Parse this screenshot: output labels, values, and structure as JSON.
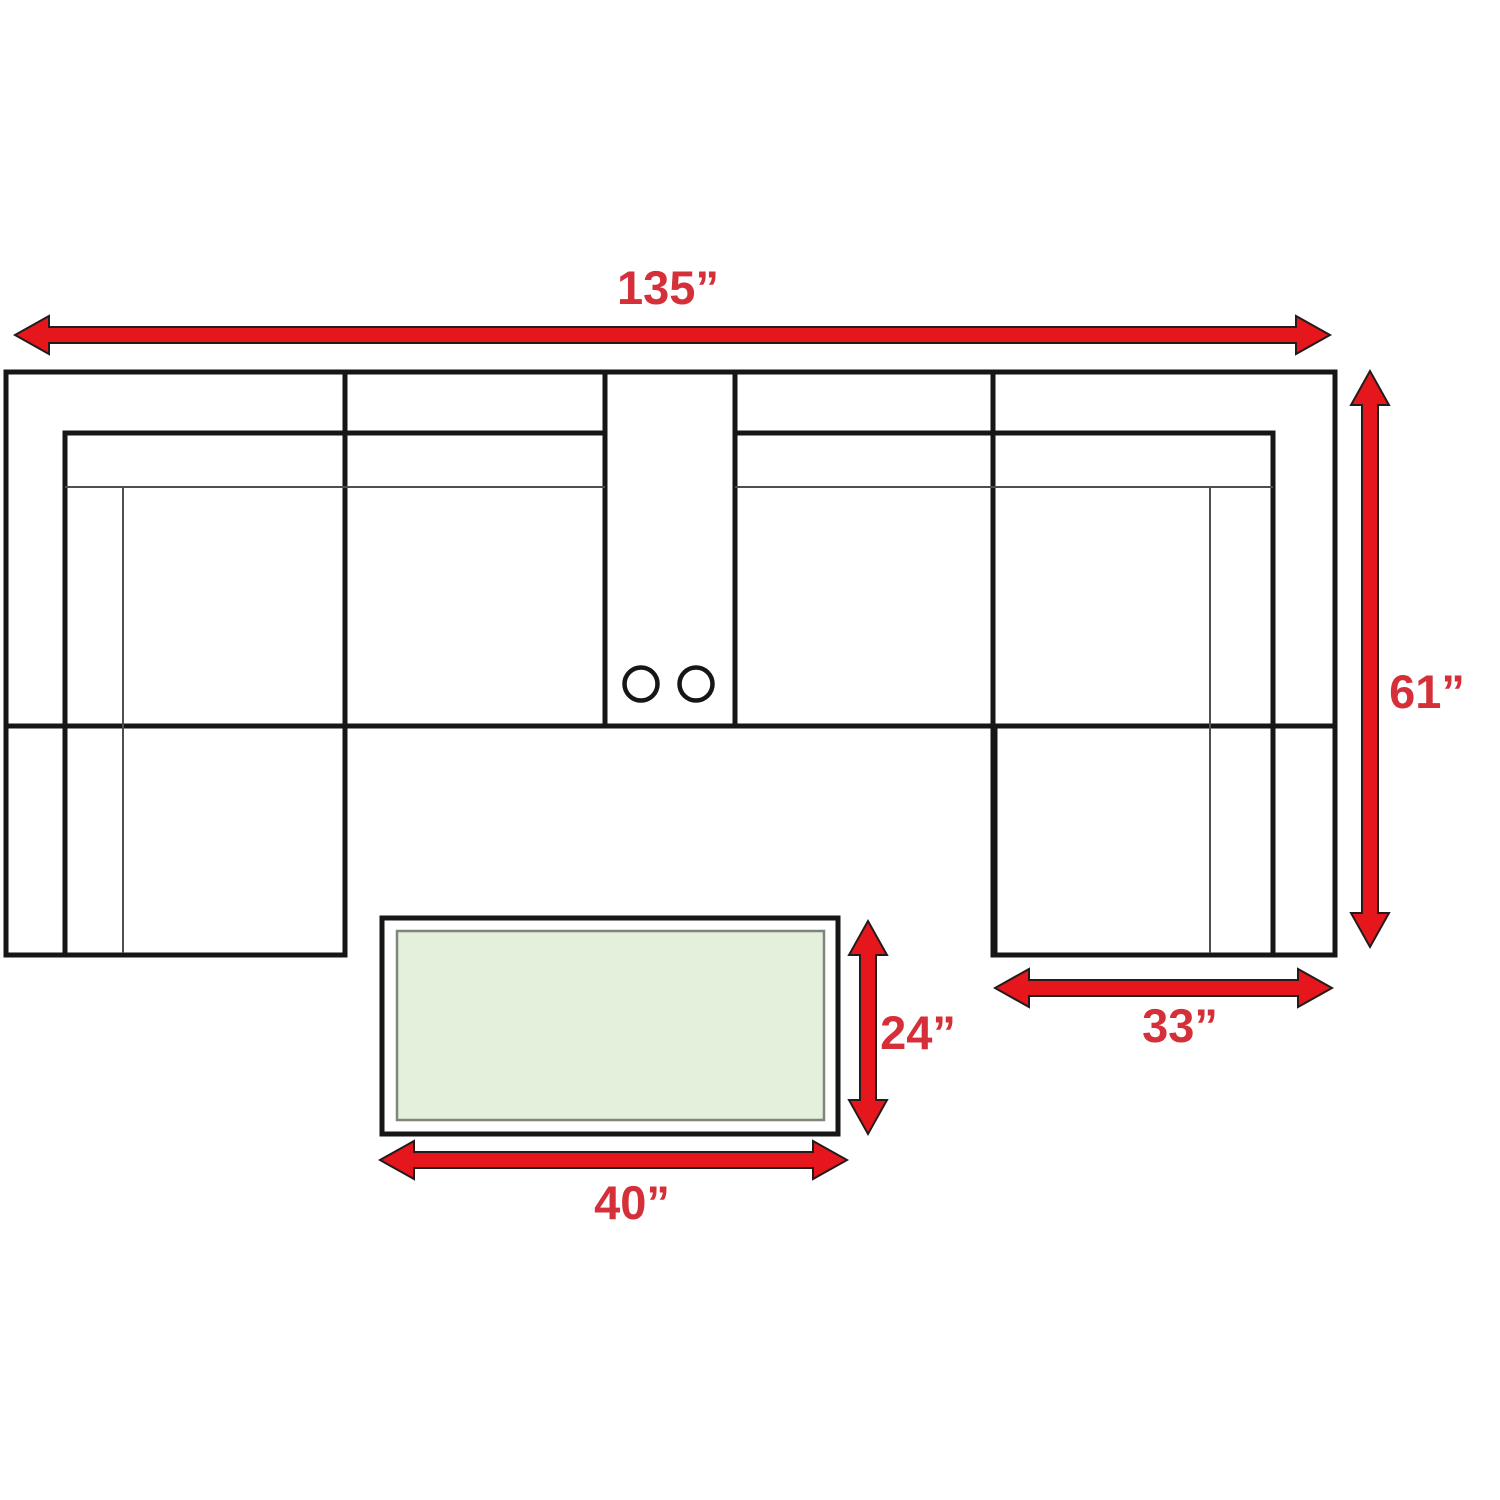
{
  "diagram": {
    "type": "sectional-sofa-floor-plan",
    "labels": {
      "overall_width": "135”",
      "overall_depth": "61”",
      "chaise_width": "33”",
      "table_depth": "24”",
      "table_width": "40”"
    },
    "colors": {
      "arrow_red": "#e6161d",
      "label_red": "#d5303a",
      "sofa_outline": "#161616",
      "seam_thin": "#4f4f4f",
      "table_fill": "#e4efdc",
      "table_inner_border": "#7d8678",
      "background": "#ffffff"
    }
  }
}
